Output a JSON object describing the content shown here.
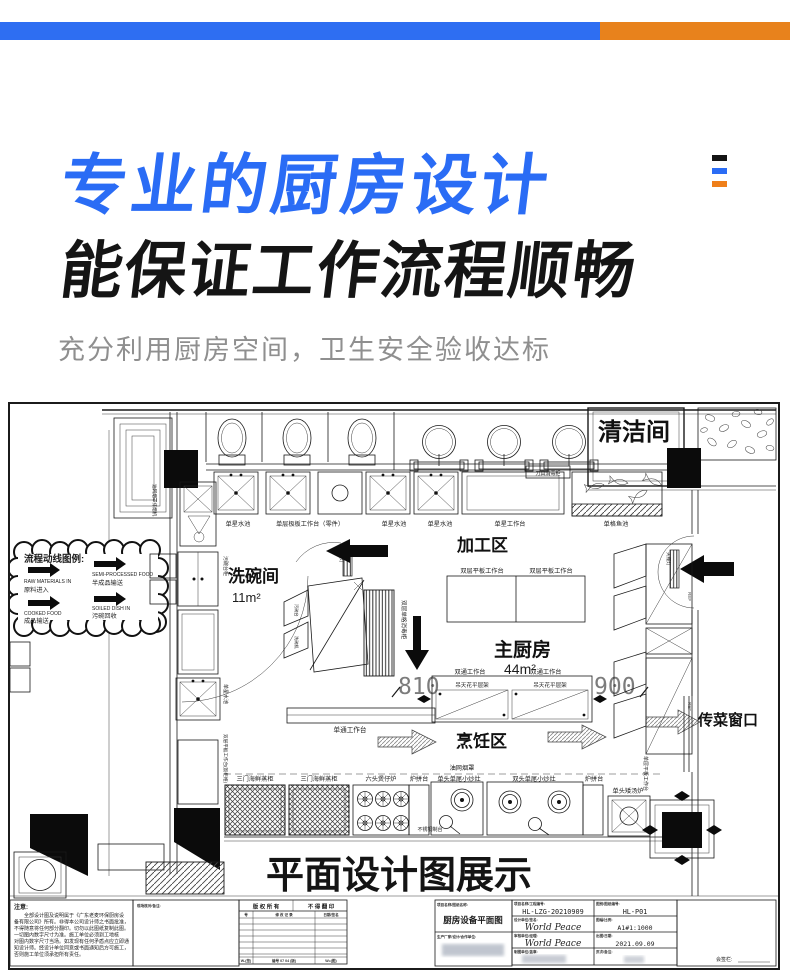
{
  "topbar": {
    "blue": "#2e6ef2",
    "orange": "#e8821c"
  },
  "menu_icon": {
    "colors": [
      "#141414",
      "#2a6cf5",
      "#ef7f1a"
    ]
  },
  "hero": {
    "title_line1": "专业的厨房设计",
    "title_line2": "能保证工作流程顺畅",
    "subtitle": "充分利用厨房空间，卫生安全验收达标",
    "accent_blue": "#2a6cf5"
  },
  "plan": {
    "caption": "平面设计图展示",
    "rooms": {
      "cleaning": "清洁间",
      "dishwashing": "洗碗间",
      "dishwashing_area": "11m²",
      "processing": "加工区",
      "main_kitchen": "主厨房",
      "main_kitchen_area": "44m²",
      "cooking": "烹饪区",
      "pass_window": "传菜窗口"
    },
    "dims": {
      "d810": "810",
      "d900": "900"
    },
    "legend": {
      "title": "流程动线图例:",
      "items": [
        {
          "en": "RAW MATERIALS IN",
          "cn": "原料进入"
        },
        {
          "en": "SEMI-PROCESSED FOOD",
          "cn": "半成品输送"
        },
        {
          "en": "COOKED FOOD",
          "cn": "成品输送"
        },
        {
          "en": "SOILED DISH IN",
          "cn": "污碗回收"
        }
      ]
    },
    "labels": {
      "sink1": "单星水池",
      "worktable_parts": "单层极板工作台（零件）",
      "sink2": "单星水池",
      "sink3": "单星水池",
      "worktable_single": "单星工作台",
      "knife_cabinet": "刀具消毒柜",
      "fish_tank": "单格鱼池",
      "double_flat_table1": "双层平板工作台",
      "double_flat_table2": "双层平板工作台",
      "double_pass_table1": "双通工作台",
      "double_pass_table2": "双通工作台",
      "ceiling_rack1": "吊天花平层架",
      "ceiling_rack2": "吊天花平层架",
      "single_pass_table": "单通工作台",
      "sterilizer": "双层单格消毒柜",
      "ceiling_lamp1": "天棚灯",
      "ceiling_lamp2": "天棚灯",
      "steamer1": "三门海鲜蒸柜",
      "steamer2": "三门海鲜蒸柜",
      "claypot_stove": "六头煲仔炉",
      "stove_side1": "炉拼台",
      "wok_single": "单头单尾小炒灶",
      "hood": "油网烟罩",
      "wok_double": "双头单尾小炒灶",
      "stove_side2": "炉拼台",
      "soup_stove": "单头矮汤炉",
      "steel_table": "不锈钢制台",
      "side_flat_table": "单层平板工作台",
      "hood_left": "油网烟罩排烟机",
      "dirty_bowl_cabinet": "污碗台柜",
      "left_sink": "单星水池",
      "left_table": "双层平板工作台(饭柜格)",
      "flap1": "污碗台",
      "flap2": "洗碗机",
      "ref1": "REF",
      "ref2": "REF"
    },
    "notes": {
      "title": "注意:",
      "lines": [
        "　　全部设计图及说明属于《广东老麦环保厨房设",
        "备有限公司》所有。非得本公司设计师之书面批准，",
        "不得随意将任何部分翻印。切勿以此图纸复制此图。",
        "一切图内数字尺寸为准。施工单位必须到工地核",
        "对图内数字尺寸当场。如发现有任何矛盾点应立即通",
        "知设计师。经设计单位同意或书面通知后方可施工，",
        "否则施工单位须承担所有责任。"
      ]
    },
    "revision": {
      "header_left": "版 权 所 有",
      "header_right": "不 得 翻 印",
      "sub": [
        "号",
        "修 改 记 录",
        "日期/签名"
      ],
      "footer": [
        "W-(签)",
        "编号 07 04 (版)",
        "W=(图)"
      ]
    },
    "titleblock": {
      "headers": {
        "remark": "现场核对/备注:",
        "name": "项目名称/图纸名称:",
        "maker": "生产厂家/设计/合作单位:",
        "project": "项目名称/工程编号:",
        "number": "图别/图纸编号:",
        "design": "设计单位/签名:",
        "scale": "图幅/比例:",
        "audit": "审核单位/经理:",
        "date": "出图/日期:",
        "draw": "制图单位/盖章:",
        "page": "页次/备注:",
        "sign": "会签栏:"
      },
      "drawing_name": "厨房设备平面图",
      "project_no": "HL-LZG-20210909",
      "drawing_no": "HL-P01",
      "design_co": "World Peace",
      "scale": "A1#1:1000",
      "audit_co": "World Peace",
      "date": "2021.09.09"
    }
  }
}
